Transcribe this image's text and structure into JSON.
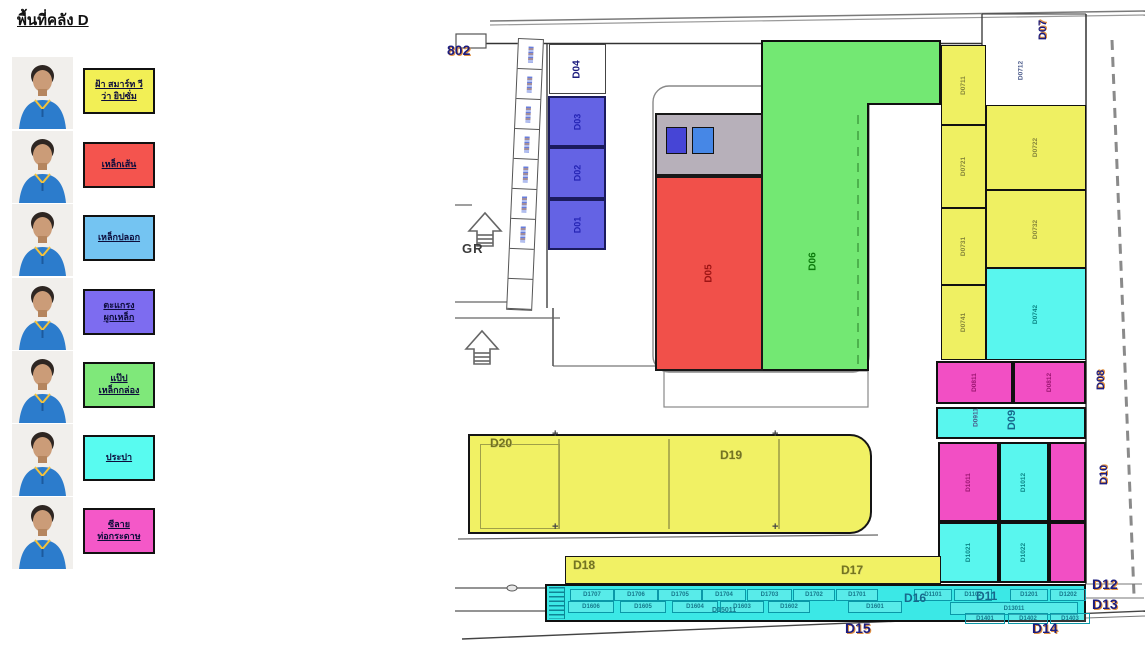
{
  "title": "พื้นที่คลัง D",
  "legend": {
    "items": [
      {
        "lines": [
          "ฝ้า สมาร์ท วี",
          "ว่า ยิปซั่ม"
        ],
        "color": "#f2ef55"
      },
      {
        "lines": [
          "เหล็กเส้น"
        ],
        "color": "#f4544e"
      },
      {
        "lines": [
          "เหล็กปลอก"
        ],
        "color": "#74c4f2"
      },
      {
        "lines": [
          "ตะแกรง",
          "ผูกเหล็ก"
        ],
        "color": "#7d6cf0"
      },
      {
        "lines": [
          "แป๊ป",
          "เหล็กกล่อง"
        ],
        "color": "#7fe87a"
      },
      {
        "lines": [
          "ประปา"
        ],
        "color": "#58fbf0"
      },
      {
        "lines": [
          "ซีลาย",
          "ท่อกระดาษ"
        ],
        "color": "#f458c8"
      }
    ]
  },
  "map": {
    "zones": [
      {
        "id": "D04",
        "label": "D04",
        "x": 549,
        "y": 44,
        "w": 57,
        "h": 50,
        "fill": "#ffffff",
        "lc": "#1c1c7e",
        "ls": 10,
        "bw": 1,
        "bc": "#444"
      },
      {
        "id": "D03",
        "label": "D03",
        "x": 548,
        "y": 96,
        "w": 58,
        "h": 51,
        "fill": "#6463e4",
        "lc": "#2424b4",
        "ls": 9,
        "bw": 2,
        "bc": "#1b1b5e"
      },
      {
        "id": "D02",
        "label": "D02",
        "x": 548,
        "y": 147,
        "w": 58,
        "h": 52,
        "fill": "#6463e4",
        "lc": "#2424b4",
        "ls": 9,
        "bw": 2,
        "bc": "#1b1b5e"
      },
      {
        "id": "D01",
        "label": "D01",
        "x": 548,
        "y": 199,
        "w": 58,
        "h": 51,
        "fill": "#6463e4",
        "lc": "#2424b4",
        "ls": 9,
        "bw": 2,
        "bc": "#1b1b5e"
      },
      {
        "id": "gray-box",
        "label": "",
        "x": 655,
        "y": 113,
        "w": 108,
        "h": 63,
        "fill": "#b7b0ba",
        "lc": "",
        "ls": 0,
        "bw": 2,
        "bc": "#181818"
      },
      {
        "id": "blue-square-1",
        "label": "",
        "x": 666,
        "y": 127,
        "w": 21,
        "h": 27,
        "fill": "#4645d6",
        "lc": "",
        "ls": 0,
        "bw": 1.5,
        "bc": "#111"
      },
      {
        "id": "blue-square-2",
        "label": "",
        "x": 692,
        "y": 127,
        "w": 22,
        "h": 27,
        "fill": "#4687e6",
        "lc": "",
        "ls": 0,
        "bw": 1.5,
        "bc": "#111"
      },
      {
        "id": "D05",
        "label": "D05",
        "x": 655,
        "y": 176,
        "w": 108,
        "h": 195,
        "fill": "#f1504a",
        "lc": "#9c1414",
        "ls": 10,
        "bw": 2,
        "bc": "#181818"
      },
      {
        "id": "D0711",
        "label": "D0711",
        "x": 941,
        "y": 45,
        "w": 45,
        "h": 80,
        "fill": "#eff062",
        "lc": "#84843a",
        "ls": 6.5,
        "bw": 1.5,
        "bc": "#101010"
      },
      {
        "id": "D0721",
        "label": "D0721",
        "x": 941,
        "y": 125,
        "w": 45,
        "h": 83,
        "fill": "#eff062",
        "lc": "#84843a",
        "ls": 6.5,
        "bw": 1.5,
        "bc": "#101010"
      },
      {
        "id": "D0731",
        "label": "D0731",
        "x": 941,
        "y": 208,
        "w": 45,
        "h": 77,
        "fill": "#eff062",
        "lc": "#84843a",
        "ls": 6.5,
        "bw": 1.5,
        "bc": "#101010"
      },
      {
        "id": "D0741",
        "label": "D0741",
        "x": 941,
        "y": 285,
        "w": 45,
        "h": 75,
        "fill": "#eff062",
        "lc": "#84843a",
        "ls": 6.5,
        "bw": 1.5,
        "bc": "#101010"
      },
      {
        "id": "D0722",
        "label": "D0722",
        "x": 986,
        "y": 105,
        "w": 100,
        "h": 85,
        "fill": "#eff062",
        "lc": "#84843a",
        "ls": 6.5,
        "bw": 1.5,
        "bc": "#101010"
      },
      {
        "id": "D0732",
        "label": "D0732",
        "x": 986,
        "y": 190,
        "w": 100,
        "h": 78,
        "fill": "#eff062",
        "lc": "#84843a",
        "ls": 6.5,
        "bw": 1.5,
        "bc": "#101010"
      },
      {
        "id": "D0742",
        "label": "D0742",
        "x": 986,
        "y": 268,
        "w": 100,
        "h": 92,
        "fill": "#59f6ee",
        "lc": "#0b8585",
        "ls": 6.5,
        "bw": 1.5,
        "bc": "#101010"
      },
      {
        "id": "D0811",
        "label": "D0811",
        "x": 936,
        "y": 361,
        "w": 77,
        "h": 43,
        "fill": "#f24fc4",
        "lc": "#9a1470",
        "ls": 6.5,
        "bw": 2,
        "bc": "#101010"
      },
      {
        "id": "D0812",
        "label": "D0812",
        "x": 1013,
        "y": 361,
        "w": 73,
        "h": 43,
        "fill": "#f24fc4",
        "lc": "#9a1470",
        "ls": 6.5,
        "bw": 2,
        "bc": "#101010"
      },
      {
        "id": "D09-strip",
        "label": "",
        "x": 936,
        "y": 407,
        "w": 150,
        "h": 32,
        "fill": "#59f6ee",
        "lc": "",
        "ls": 0,
        "bw": 2,
        "bc": "#101010"
      },
      {
        "id": "D1011",
        "label": "D1011",
        "x": 938,
        "y": 442,
        "w": 61,
        "h": 80,
        "fill": "#f24fc4",
        "lc": "#9a1470",
        "ls": 6.5,
        "bw": 2,
        "bc": "#101010"
      },
      {
        "id": "D1012",
        "label": "D1012",
        "x": 999,
        "y": 442,
        "w": 50,
        "h": 80,
        "fill": "#59f6ee",
        "lc": "#0b8585",
        "ls": 6.5,
        "bw": 2,
        "bc": "#101010"
      },
      {
        "id": "D1021",
        "label": "D1021",
        "x": 938,
        "y": 522,
        "w": 61,
        "h": 61,
        "fill": "#59f6ee",
        "lc": "#0b8585",
        "ls": 6.5,
        "bw": 2,
        "bc": "#101010"
      },
      {
        "id": "D1022",
        "label": "D1022",
        "x": 999,
        "y": 522,
        "w": 50,
        "h": 61,
        "fill": "#59f6ee",
        "lc": "#0b8585",
        "ls": 6.5,
        "bw": 2,
        "bc": "#101010"
      },
      {
        "id": "magenta-col-top",
        "label": "",
        "x": 1049,
        "y": 442,
        "w": 37,
        "h": 80,
        "fill": "#f24fc4",
        "lc": "",
        "ls": 0,
        "bw": 2,
        "bc": "#101010"
      },
      {
        "id": "magenta-col-bottom",
        "label": "",
        "x": 1049,
        "y": 522,
        "w": 37,
        "h": 61,
        "fill": "#f24fc4",
        "lc": "",
        "ls": 0,
        "bw": 2,
        "bc": "#101010"
      }
    ],
    "green_zone": {
      "label": "D06"
    },
    "labels": [
      {
        "t": "802",
        "x": 447,
        "y": 42,
        "cls": "lbl-navy",
        "fs": 14
      },
      {
        "t": "GR",
        "x": 462,
        "y": 241,
        "cls": "lbl-gr",
        "fs": 13
      },
      {
        "t": "D07",
        "cx": 1043,
        "cy": 33,
        "rot": 1,
        "cls": "lbl-navy",
        "fs": 11
      },
      {
        "t": "D0712",
        "cx": 1021,
        "cy": 76,
        "rot": 1,
        "cls": "lbl-code",
        "fs": 6.5
      },
      {
        "t": "D06",
        "cx": 813,
        "cy": 265,
        "rot": 1,
        "cls": "lbl-green",
        "fs": 10
      },
      {
        "t": "D08",
        "cx": 1101,
        "cy": 383,
        "rot": 1,
        "cls": "lbl-navy",
        "fs": 11
      },
      {
        "t": "D09",
        "cx": 1012,
        "cy": 423,
        "rot": 1,
        "cls": "lbl-teal-b",
        "fs": 11
      },
      {
        "t": "D0911",
        "cx": 976,
        "cy": 423,
        "rot": 1,
        "cls": "lbl-code",
        "fs": 6.5
      },
      {
        "t": "D10",
        "cx": 1104,
        "cy": 478,
        "rot": 1,
        "cls": "lbl-navy",
        "fs": 11
      },
      {
        "t": "D20",
        "x": 490,
        "y": 436,
        "cls": "lbl-olive",
        "fs": 12
      },
      {
        "t": "D19",
        "x": 720,
        "y": 448,
        "cls": "lbl-olive",
        "fs": 12
      },
      {
        "t": "D18",
        "x": 573,
        "y": 558,
        "cls": "lbl-olive",
        "fs": 12
      },
      {
        "t": "D17",
        "x": 841,
        "y": 563,
        "cls": "lbl-olive",
        "fs": 12
      },
      {
        "t": "D16",
        "x": 904,
        "y": 591,
        "cls": "lbl-teal-b",
        "fs": 12
      },
      {
        "t": "D11",
        "x": 976,
        "y": 589,
        "cls": "lbl-teal-b",
        "fs": 12
      },
      {
        "t": "D15011",
        "x": 712,
        "y": 607,
        "cls": "lbl-teal",
        "fs": 7
      },
      {
        "t": "D12",
        "x": 1092,
        "y": 576,
        "cls": "lbl-navy",
        "fs": 14
      },
      {
        "t": "D13",
        "x": 1092,
        "y": 596,
        "cls": "lbl-navy",
        "fs": 14
      },
      {
        "t": "D14",
        "x": 1032,
        "y": 620,
        "cls": "lbl-navy",
        "fs": 14
      },
      {
        "t": "D15",
        "x": 845,
        "y": 620,
        "cls": "lbl-navy",
        "fs": 14
      }
    ],
    "corridor": {
      "cell_count": 9,
      "labelled_cells": 7
    },
    "bottom_strip": {
      "row1": [
        [
          "D1707",
          568,
          42
        ],
        [
          "D1706",
          612,
          42
        ],
        [
          "D1705",
          656,
          42
        ],
        [
          "D1704",
          700,
          42
        ],
        [
          "D1703",
          745,
          43
        ],
        [
          "D1702",
          791,
          40
        ],
        [
          "D1701",
          834,
          40
        ],
        [
          "D1101",
          912,
          36
        ],
        [
          "D1102",
          952,
          36
        ],
        [
          "D1201",
          1008,
          36
        ],
        [
          "D1202",
          1048,
          34
        ]
      ],
      "row2": [
        [
          "D1606",
          566,
          44
        ],
        [
          "D1605",
          618,
          44
        ],
        [
          "D1604",
          670,
          44
        ],
        [
          "D1603",
          718,
          42
        ],
        [
          "D1602",
          766,
          40
        ],
        [
          "D1601",
          846,
          52
        ]
      ],
      "wide": {
        "t": "D13011",
        "x": 948,
        "w": 126
      },
      "row3": [
        [
          "D1401",
          963,
          38
        ],
        [
          "D1402",
          1006,
          38
        ],
        [
          "D1403",
          1048,
          38
        ]
      ]
    }
  }
}
